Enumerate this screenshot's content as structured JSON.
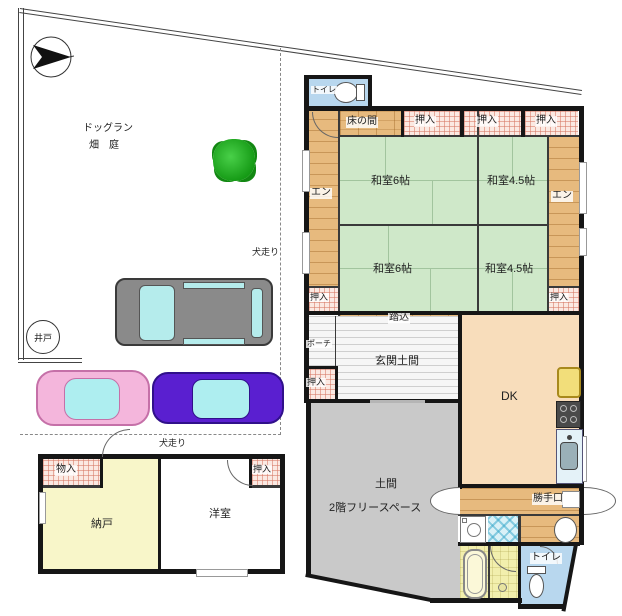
{
  "title": "間取り図（平面図）",
  "site": {
    "dog_run": "ドッグラン",
    "field_garden": "畑　庭",
    "inubashiri": "犬走り",
    "well": "井戸"
  },
  "house": {
    "toilet": "トイレ",
    "tokonoma": "床の間",
    "oshiire": "押入",
    "washitsu_6": "和室6帖",
    "washitsu_45": "和室4.5帖",
    "engawa": "エン",
    "fumikomi": "踏込",
    "porch": "ポーチ",
    "genkan_doma": "玄関土間",
    "dk": "DK",
    "doma": "土間",
    "free_space": "2階フリースペース",
    "katteguchi": "勝手口",
    "mono_ire": "物入",
    "nando": "納戸",
    "yoshitsu": "洋室"
  },
  "colors": {
    "tatami_green": "#cfe8c9",
    "engawa_wood": "#e7ba7e",
    "closet_hatch_pink": "#fbe9e2",
    "dk_peach": "#f8ddbb",
    "doma_gray": "#c9c9c9",
    "nando_yellow": "#f8f6c9",
    "toilet_blue": "#b8d7ee",
    "bath_yellow": "#f2efad",
    "washroom_blue": "#d9f1f7",
    "car_pink": "#f4b6dc",
    "car_purple": "#5a1fd0",
    "car_gray": "#8a8a8a",
    "tree_green": "#2eb82e",
    "wall_black": "#161616"
  }
}
